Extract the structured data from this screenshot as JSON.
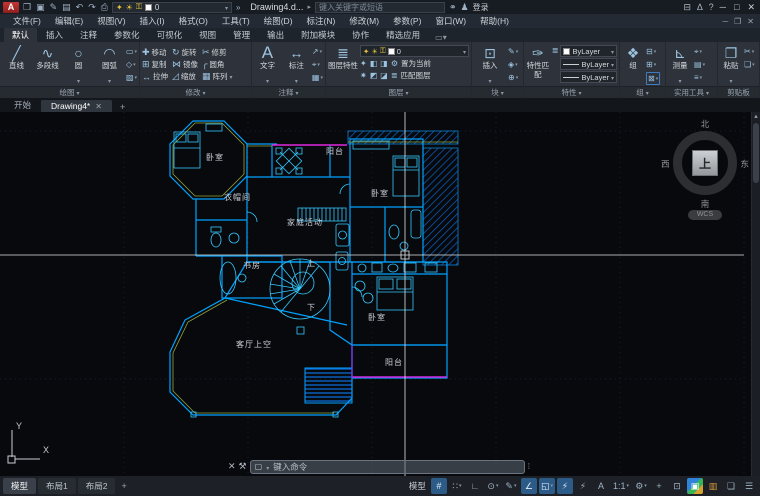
{
  "colors": {
    "plan_cyan": "#00a2ff",
    "plan_bright": "#35c8ff",
    "magenta": "#e028e0",
    "olive": "#93a83b",
    "accent_blue": "#2b5b86"
  },
  "titlebar": {
    "logo": "A",
    "doc_title": "Drawing4.d...",
    "search_placeholder": "键入关键字或短语",
    "signin": "登录",
    "qat_icons": [
      {
        "name": "open-icon",
        "glyph": "❒"
      },
      {
        "name": "save-icon",
        "glyph": "▣"
      },
      {
        "name": "save-as-icon",
        "glyph": "✎"
      },
      {
        "name": "plot-icon",
        "glyph": "▤"
      },
      {
        "name": "undo-icon",
        "glyph": "↶"
      },
      {
        "name": "redo-icon",
        "glyph": "↷"
      },
      {
        "name": "print-icon",
        "glyph": "⎙"
      }
    ],
    "layer_combo_value": "0",
    "right_icons": [
      {
        "name": "app-store-icon",
        "glyph": "⊟"
      },
      {
        "name": "autodesk-icon",
        "glyph": "∆"
      },
      {
        "name": "help-icon",
        "glyph": "?"
      }
    ]
  },
  "menubar": {
    "items": [
      "文件(F)",
      "编辑(E)",
      "视图(V)",
      "插入(I)",
      "格式(O)",
      "工具(T)",
      "绘图(D)",
      "标注(N)",
      "修改(M)",
      "参数(P)",
      "窗口(W)",
      "帮助(H)"
    ]
  },
  "ribbon": {
    "tabs": [
      {
        "label": "默认",
        "active": true
      },
      {
        "label": "插入"
      },
      {
        "label": "注释"
      },
      {
        "label": "参数化"
      },
      {
        "label": "可视化"
      },
      {
        "label": "视图"
      },
      {
        "label": "管理"
      },
      {
        "label": "输出"
      },
      {
        "label": "附加模块"
      },
      {
        "label": "协作"
      },
      {
        "label": "精选应用"
      }
    ],
    "draw": {
      "title": "绘图",
      "line": "直线",
      "polyline": "多段线",
      "circle": "圆",
      "arc": "圆弧",
      "minis": [
        {
          "name": "rectangle-icon",
          "glyph": "▭"
        },
        {
          "name": "ellipse-icon",
          "glyph": "◇"
        },
        {
          "name": "hatch-icon",
          "glyph": "▨"
        }
      ]
    },
    "modify": {
      "title": "修改",
      "move": "移动",
      "rotate": "旋转",
      "trim": "修剪",
      "copy": "复制",
      "mirror": "镜像",
      "fillet": "圆角",
      "stretch": "拉伸",
      "scale": "缩放",
      "array": "阵列"
    },
    "annotation": {
      "title": "注释",
      "text": "文字",
      "dimension": "标注",
      "minis": [
        {
          "name": "leader-icon",
          "glyph": "↗"
        },
        {
          "name": "dim-style-icon",
          "glyph": "⌖"
        },
        {
          "name": "table-icon",
          "glyph": "▦"
        }
      ]
    },
    "layers": {
      "title": "图层",
      "properties": "图层特性",
      "current_layer": "0",
      "set_current": "置为当前",
      "match_layer": "匹配图层",
      "minis1": [
        {
          "name": "layer-off-icon",
          "glyph": "✦"
        },
        {
          "name": "layer-isolate-icon",
          "glyph": "◧"
        },
        {
          "name": "layer-freeze-icon",
          "glyph": "◨"
        },
        {
          "name": "layer-lock-icon",
          "glyph": "⚙"
        }
      ],
      "minis2": [
        {
          "name": "layer-on-icon",
          "glyph": "✷"
        },
        {
          "name": "layer-unisolate-icon",
          "glyph": "◩"
        },
        {
          "name": "layer-thaw-icon",
          "glyph": "◪"
        },
        {
          "name": "layer-unlock-icon",
          "glyph": "≣"
        }
      ]
    },
    "block": {
      "title": "块",
      "insert": "插入",
      "minis": [
        {
          "name": "block-edit-icon",
          "glyph": "✎"
        },
        {
          "name": "block-create-icon",
          "glyph": "◈"
        },
        {
          "name": "block-attr-icon",
          "glyph": "⊕"
        }
      ]
    },
    "properties": {
      "title": "特性",
      "match": "特性匹配",
      "list_icon": "≣",
      "color": "ByLayer",
      "linetype": "ByLayer",
      "lineweight": "ByLayer"
    },
    "groups": {
      "title": "组",
      "group": "组",
      "minis": [
        {
          "name": "ungroup-icon",
          "glyph": "⊟"
        },
        {
          "name": "group-edit-icon",
          "glyph": "⊞"
        },
        {
          "name": "group-select-icon",
          "glyph": "⊠",
          "hl": true
        }
      ]
    },
    "utilities": {
      "title": "实用工具",
      "measure": "测量",
      "minis": [
        {
          "name": "id-point-icon",
          "glyph": "⌖"
        },
        {
          "name": "quick-calc-icon",
          "glyph": "▤"
        },
        {
          "name": "quick-select-icon",
          "glyph": "≡"
        }
      ]
    },
    "clipboard": {
      "title": "剪贴板",
      "paste": "粘贴",
      "minis": [
        {
          "name": "cut-icon",
          "glyph": "✂"
        },
        {
          "name": "copy-clip-icon",
          "glyph": "❏"
        }
      ]
    },
    "view": {
      "title": "视图",
      "base": "基点"
    }
  },
  "file_tabs": {
    "start": "开始",
    "drawing": "Drawing4*"
  },
  "canvas": {
    "labels": [
      {
        "text": "卧室",
        "x": 206,
        "y": 40
      },
      {
        "text": "阳台",
        "x": 326,
        "y": 34
      },
      {
        "text": "卧室",
        "x": 371,
        "y": 76
      },
      {
        "text": "衣帽间",
        "x": 224,
        "y": 80
      },
      {
        "text": "家庭活动",
        "x": 287,
        "y": 105
      },
      {
        "text": "书房",
        "x": 243,
        "y": 148
      },
      {
        "text": "上",
        "x": 307,
        "y": 146
      },
      {
        "text": "下",
        "x": 307,
        "y": 190
      },
      {
        "text": "客厅上空",
        "x": 236,
        "y": 227
      },
      {
        "text": "卧室",
        "x": 368,
        "y": 200
      },
      {
        "text": "阳台",
        "x": 385,
        "y": 245
      }
    ],
    "viewcube": {
      "north": "北",
      "south": "南",
      "east": "东",
      "west": "西",
      "top": "上",
      "wcs": "WCS"
    },
    "ucs": {
      "x": "X",
      "y": "Y"
    }
  },
  "commandbar": {
    "placeholder": "键入命令"
  },
  "statusbar": {
    "tabs": [
      {
        "label": "模型",
        "active": true
      },
      {
        "label": "布局1"
      },
      {
        "label": "布局2"
      }
    ],
    "new_layout": "+",
    "model_button": "模型",
    "icons": [
      {
        "name": "grid-toggle",
        "glyph": "#",
        "active": true
      },
      {
        "name": "snap-toggle",
        "glyph": "∷",
        "caret": true
      },
      {
        "name": "ortho-toggle",
        "glyph": "∟"
      },
      {
        "name": "polar-toggle",
        "glyph": "⊙",
        "caret": true
      },
      {
        "name": "isodraft-toggle",
        "glyph": "✎",
        "caret": true
      },
      {
        "name": "otrack-toggle",
        "glyph": "∠",
        "active": true
      },
      {
        "name": "osnap-toggle",
        "glyph": "◱",
        "active": true,
        "caret": true
      },
      {
        "name": "annotation-visibility-toggle",
        "glyph": "⚡",
        "active": true
      },
      {
        "name": "annotation-autoscale-toggle",
        "glyph": "⚡"
      },
      {
        "name": "annotation-scale-icon",
        "glyph": "A"
      },
      {
        "name": "annotation-scale-value",
        "label": "1:1",
        "caret": true
      },
      {
        "name": "workspace-gear",
        "glyph": "⚙",
        "caret": true
      },
      {
        "name": "annotation-monitor",
        "glyph": "+"
      },
      {
        "name": "isolate-objects",
        "glyph": "⊡"
      },
      {
        "name": "graphics-performance",
        "glyph": "▣",
        "cls": "multi"
      },
      {
        "name": "hardware-accel",
        "glyph": "▥",
        "cls": "warn"
      },
      {
        "name": "clean-screen",
        "glyph": "❏"
      },
      {
        "name": "customize-menu",
        "glyph": "☰"
      }
    ]
  }
}
